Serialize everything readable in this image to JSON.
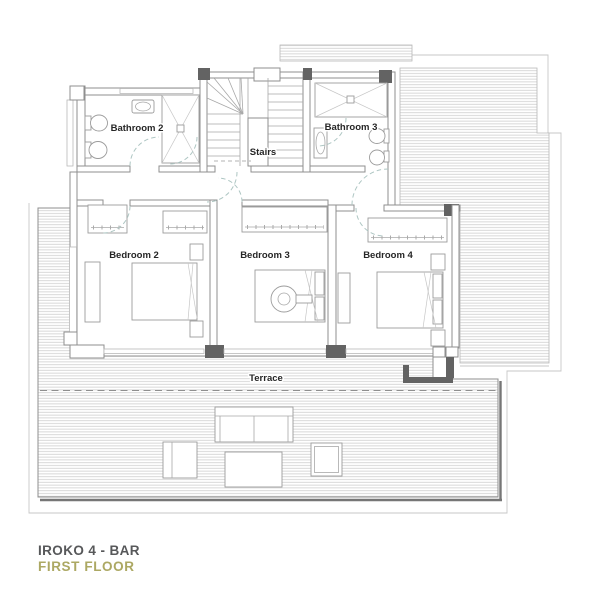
{
  "plan": {
    "rooms": {
      "bathroom2": {
        "label": "Bathroom 2"
      },
      "bathroom3": {
        "label": "Bathroom 3"
      },
      "stairs": {
        "label": "Stairs"
      },
      "bedroom2": {
        "label": "Bedroom 2"
      },
      "bedroom3": {
        "label": "Bedroom 3"
      },
      "bedroom4": {
        "label": "Bedroom 4"
      },
      "terrace": {
        "label": "Terrace"
      }
    },
    "title": {
      "line1": "IROKO 4 - BAR",
      "line2": "FIRST FLOOR"
    },
    "colors": {
      "background": "#ffffff",
      "wall_line": "#8f8f8f",
      "dark_wall": "#636363",
      "hatch_line": "#cfcfcf",
      "label_text": "#262626",
      "door_swing": "#aec6c3",
      "title_primary": "#57585a",
      "title_accent": "#aca863"
    }
  }
}
